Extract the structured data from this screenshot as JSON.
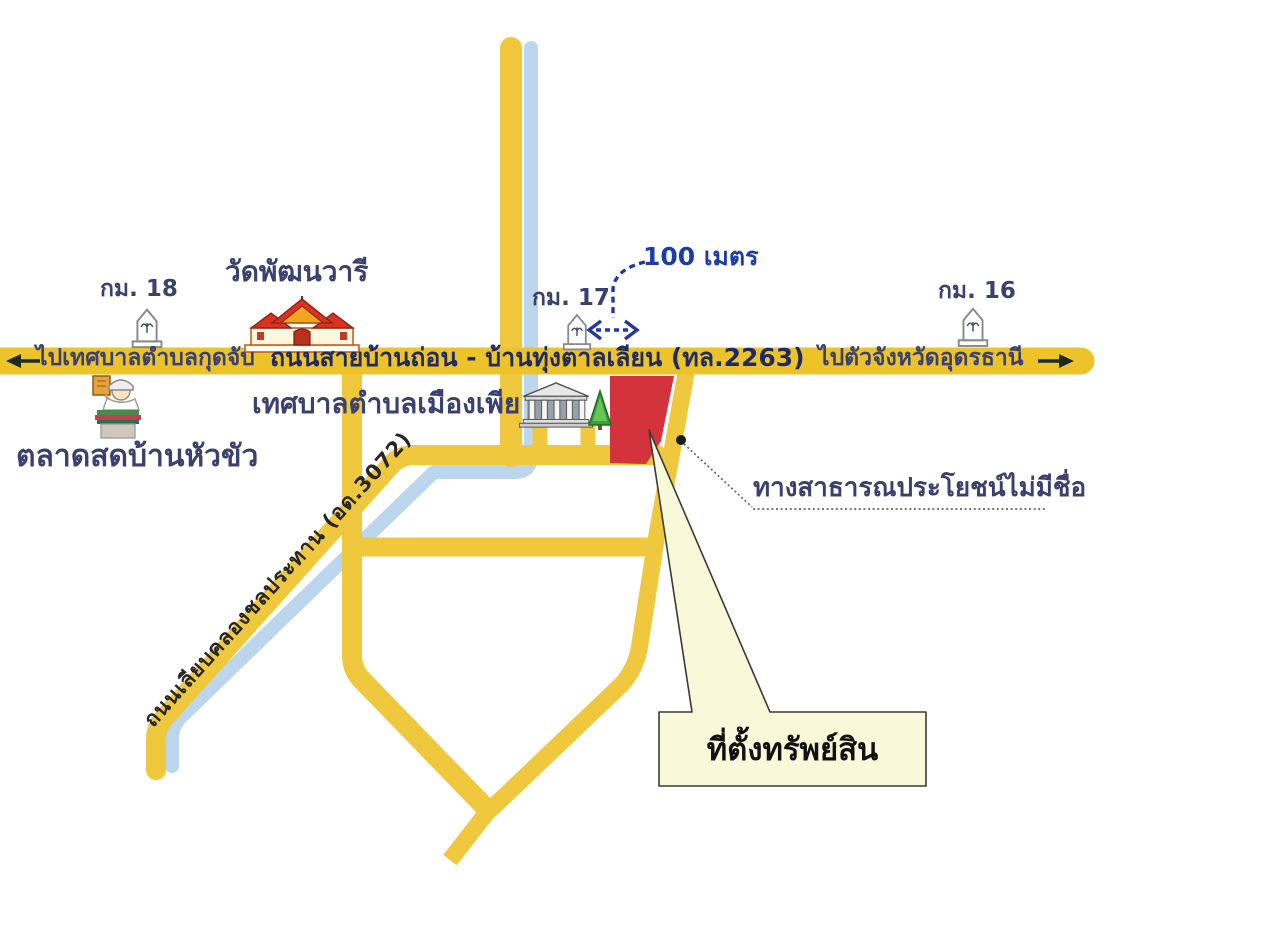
{
  "title": "แผนที่ตั้งทรัพย์สิน (property location sketch map)",
  "colors": {
    "road_yellow_main": "#edc32a",
    "road_yellow": "#f0c83e",
    "canal_blue": "#bcd6ee",
    "parcel_red": "#d2333d",
    "callout_fill": "#f8f9d8",
    "label_navy": "#3a4070",
    "road_text_navy": "#1f2a60",
    "distance_blue": "#1c3da8",
    "leader_gray": "#666666"
  },
  "markers": {
    "km18": {
      "label": "กม. 18"
    },
    "km17": {
      "label": "กม. 17"
    },
    "km16": {
      "label": "กม. 16"
    }
  },
  "places": {
    "temple": {
      "label": "วัดพัฒนวารี"
    },
    "municipality": {
      "label": "เทศบาลตำบลเมืองเพีย"
    },
    "market": {
      "label": "ตลาดสดบ้านหัวขัว"
    }
  },
  "main_road": {
    "west_label": "ไปเทศบาลตำบลกุดจับ",
    "name": "ถนนสายบ้านถ่อน - บ้านทุ่งตาลเลียน (ทล.2263)",
    "east_label": "ไปตัวจังหวัดอุดรธานี"
  },
  "annotations": {
    "distance": "100 เมตร",
    "public_way": "ทางสาธารณประโยชน์ไม่มีชื่อ",
    "canal_road": "ถนนเลียบคลองชลประทาน (อด.3072)",
    "property_callout": "ที่ตั้งทรัพย์สิน"
  }
}
